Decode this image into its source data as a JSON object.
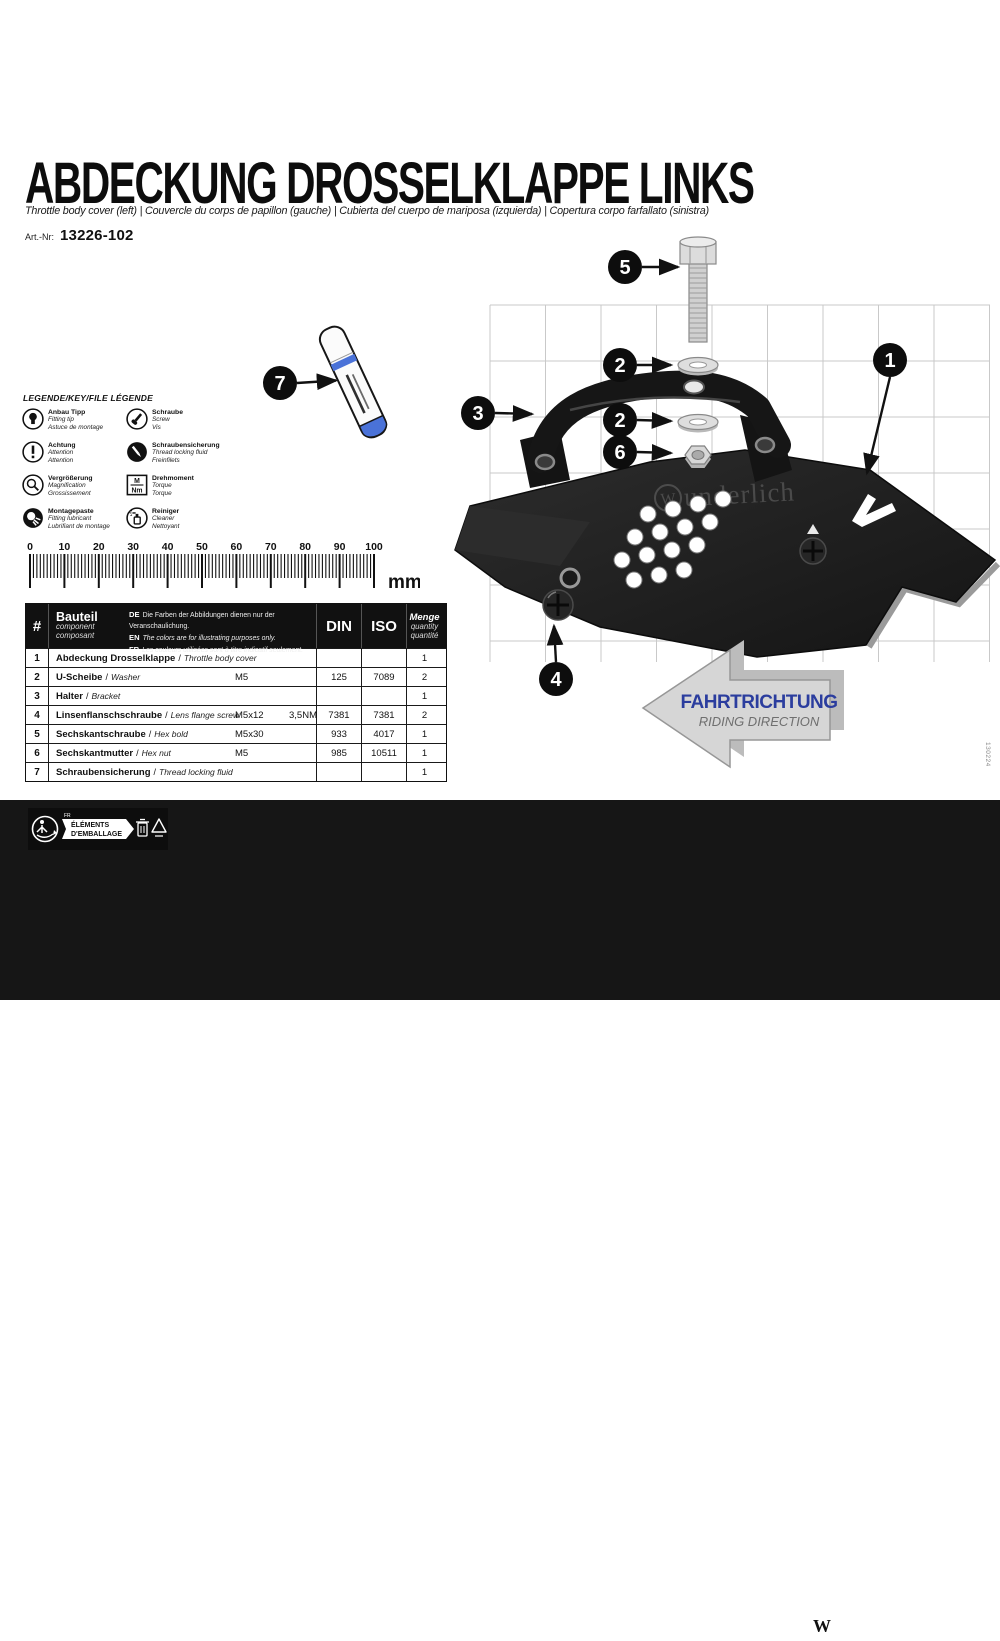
{
  "page": {
    "code": "130224"
  },
  "header": {
    "title": "ABDECKUNG DROSSELKLAPPE LINKS",
    "subtitle": "Throttle body cover (left) | Couvercle du corps de papillon (gauche) | Cubierta del cuerpo de mariposa (izquierda) | Copertura corpo farfallato (sinistra)",
    "art_label": "Art.-Nr:",
    "art_number": "13226-102"
  },
  "legend": {
    "title": "LEGENDE/KEY/FILE LÉGENDE",
    "items": [
      {
        "icon": "bulb",
        "de": "Anbau Tipp",
        "en": "Fitting tip",
        "fr": "Astuce de montage"
      },
      {
        "icon": "exclamation",
        "de": "Achtung",
        "en": "Attention",
        "fr": "Attention"
      },
      {
        "icon": "magnifier",
        "de": "Vergrößerung",
        "en": "Magnification",
        "fr": "Grossissement"
      },
      {
        "icon": "grease",
        "de": "Montagepaste",
        "en": "Fitting lubricant",
        "fr": "Lubrifiant de montage"
      },
      {
        "icon": "screw",
        "de": "Schraube",
        "en": "Screw",
        "fr": "Vis"
      },
      {
        "icon": "threadlock",
        "de": "Schraubensicherung",
        "en": "Thread locking fluid",
        "fr": "Freinfilets"
      },
      {
        "icon": "torque",
        "box_top": "M",
        "box_bottom": "Nm",
        "de": "Drehmoment",
        "en": "Torque",
        "fr": "Torque"
      },
      {
        "icon": "cleaner",
        "de": "Reiniger",
        "en": "Cleaner",
        "fr": "Nettoyant"
      }
    ]
  },
  "ruler": {
    "unit": "mm",
    "min": 0,
    "max": 100,
    "labels": [
      "0",
      "10",
      "20",
      "30",
      "40",
      "50",
      "60",
      "70",
      "80",
      "90",
      "100"
    ]
  },
  "table": {
    "header": {
      "hash": "#",
      "part_de": "Bauteil",
      "part_en": "component",
      "part_fr": "composant",
      "disclaimer": {
        "de_tag": "DE",
        "de": "Die Farben der Abbildungen dienen nur der Veranschaulichung.",
        "en_tag": "EN",
        "en": "The colors are for illustrating purposes only.",
        "fr_tag": "FR",
        "fr": "Les couleurs utilisées sont à titre indicatif seulement."
      },
      "din": "DIN",
      "iso": "ISO",
      "qty_de": "Menge",
      "qty_en": "quantity",
      "qty_fr": "quantité"
    },
    "rows": [
      {
        "num": "1",
        "name_de": "Abdeckung Drosselklappe",
        "name_en": "Throttle body cover",
        "size": "",
        "torque": "",
        "din": "",
        "iso": "",
        "qty": "1"
      },
      {
        "num": "2",
        "name_de": "U-Scheibe",
        "name_en": "Washer",
        "size": "M5",
        "torque": "",
        "din": "125",
        "iso": "7089",
        "qty": "2"
      },
      {
        "num": "3",
        "name_de": "Halter",
        "name_en": "Bracket",
        "size": "",
        "torque": "",
        "din": "",
        "iso": "",
        "qty": "1"
      },
      {
        "num": "4",
        "name_de": "Linsenflanschschraube",
        "name_en": "Lens flange screw",
        "size": "M5x12",
        "torque": "3,5NM",
        "din": "7381",
        "iso": "7381",
        "qty": "2"
      },
      {
        "num": "5",
        "name_de": "Sechskantschraube",
        "name_en": "Hex bold",
        "size": "M5x30",
        "torque": "",
        "din": "933",
        "iso": "4017",
        "qty": "1"
      },
      {
        "num": "6",
        "name_de": "Sechskantmutter",
        "name_en": "Hex nut",
        "size": "M5",
        "torque": "",
        "din": "985",
        "iso": "10511",
        "qty": "1"
      },
      {
        "num": "7",
        "name_de": "Schraubensicherung",
        "name_en": "Thread locking fluid",
        "size": "",
        "torque": "",
        "din": "",
        "iso": "",
        "qty": "1"
      }
    ]
  },
  "diagram": {
    "callouts": {
      "c1": "1",
      "c2": "2",
      "c3": "3",
      "c4": "4",
      "c5": "5",
      "c6": "6",
      "c7": "7"
    },
    "watermark_w": "W",
    "watermark_text": "underlich",
    "direction_arrow": {
      "label": "FAHRTRICHTUNG",
      "sublabel": "RIDING DIRECTION"
    }
  },
  "footer": {
    "page_number": "1",
    "packaging": {
      "cc": "FR",
      "line1": "ÉLÉMENTS",
      "line2": "D'EMBALLAGE"
    },
    "brand": {
      "w": "W",
      "name": "Wunderlich",
      "reg": "®"
    }
  },
  "colors": {
    "ink": "#111111",
    "arrow_blue": "#2b3d9e",
    "pen_blue": "#4a72d8",
    "grid_gray": "#c9c9c9"
  }
}
